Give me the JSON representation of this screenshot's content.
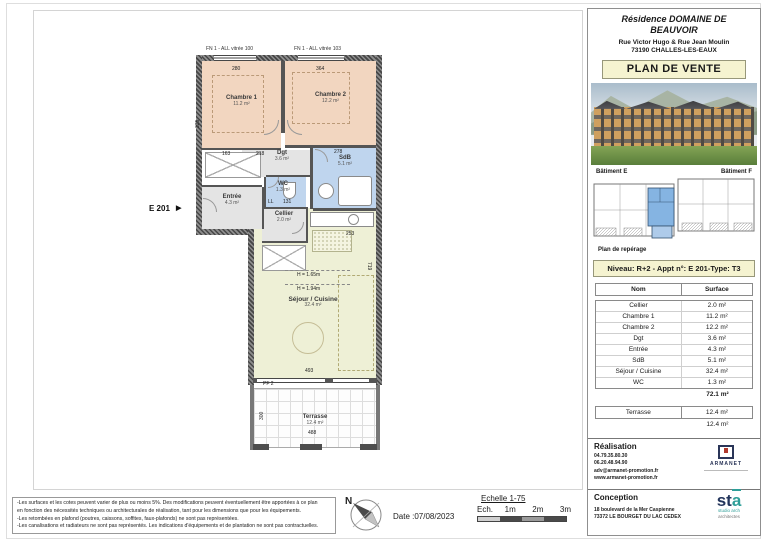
{
  "header": {
    "title_line1": "Résidence DOMAINE DE",
    "title_line2": "BEAUVOIR",
    "address_line1": "Rue Victor Hugo & Rue Jean Moulin",
    "address_line2": "73190 CHALLES-LES-EAUX",
    "plan_label": "PLAN DE VENTE"
  },
  "reperage": {
    "batiment_left": "Bâtiment E",
    "batiment_right": "Bâtiment F",
    "caption": "Plan de repérage"
  },
  "apartment_info": "Niveau: R+2  - Appt n°: E 201-Type: T3",
  "surface_table": {
    "col_name": "Nom",
    "col_surface": "Surface",
    "rows": [
      {
        "name": "Cellier",
        "surface": "2.0 m²"
      },
      {
        "name": "Chambre 1",
        "surface": "11.2 m²"
      },
      {
        "name": "Chambre 2",
        "surface": "12.2 m²"
      },
      {
        "name": "Dgt",
        "surface": "3.6 m²"
      },
      {
        "name": "Entrée",
        "surface": "4.3 m²"
      },
      {
        "name": "SdB",
        "surface": "5.1 m²"
      },
      {
        "name": "Séjour / Cuisine",
        "surface": "32.4 m²"
      },
      {
        "name": "WC",
        "surface": "1.3 m²"
      }
    ],
    "total": "72.1 m²",
    "terrasse_name": "Terrasse",
    "terrasse_surface": "12.4 m²",
    "terrasse_total": "12.4 m²"
  },
  "realisation": {
    "title": "Réalisation",
    "phone1": "04.79.35.80.30",
    "phone2": "06.20.48.94.90",
    "email": "adv@armanet-promotion.fr",
    "website": "www.armanet-promotion.fr",
    "logo_text": "ARMANET"
  },
  "conception": {
    "title": "Conception",
    "address_line1": "18 boulevard de la Mer Caspienne",
    "address_line2": "73372 LE BOURGET DU LAC CEDEX",
    "logo_st": "st",
    "logo_a": "a",
    "logo_sub1": "studio arch",
    "logo_sub2": "architectes"
  },
  "plan": {
    "unit_label": "E 201",
    "unit_arrow": "▶",
    "window_label_1": "FN 1 - ALL vitrée 100",
    "window_label_2": "FN 1 - ALL vitrée 103",
    "rooms": {
      "chambre1": {
        "name": "Chambre 1",
        "area": "11.2 m²"
      },
      "chambre2": {
        "name": "Chambre 2",
        "area": "12.2 m²"
      },
      "dgt": {
        "name": "Dgt",
        "area": "3.6 m²"
      },
      "sdb": {
        "name": "SdB",
        "area": "5.1 m²"
      },
      "wc": {
        "name": "WC",
        "area": "1.3 m²"
      },
      "entree": {
        "name": "Entrée",
        "area": "4.3 m²"
      },
      "cellier": {
        "name": "Cellier",
        "area": "2.0 m²"
      },
      "sejour": {
        "name": "Séjour / Cuisine",
        "area": "32.4 m²"
      },
      "terrasse": {
        "name": "Terrasse",
        "area": "12.4 m²"
      }
    },
    "heights": {
      "h1": "H = 1.65m",
      "h2": "H = 1.94m"
    },
    "dims": {
      "top1": "280",
      "top2": "364",
      "left1": "325",
      "mid1": "163",
      "mid2": "218",
      "sdb": "278",
      "kitchen": "253",
      "sejour_w": "493",
      "sejour_h": "719",
      "terr_h": "300",
      "terr_w": "488",
      "pf": "PF 2",
      "ll": "LL",
      "n131": "131"
    }
  },
  "footer": {
    "disclaimer_line1": "-Les surfaces et les cotes peuvent varier de plus ou moins 5%. Des modifications peuvent éventuellement être apportées à ce plan",
    "disclaimer_line2": "en fonction des nécessités techniques ou architecturales de réalisation, tant pour les dimensions que pour les équipements.",
    "disclaimer_line3": "-Les retombées en plafond (poutres, caissons, soffites, faux-plafonds) ne sont pas représentées.",
    "disclaimer_line4": "-Les canalisations et radiateurs ne sont pas représentés. Les indications d'équipements et de plantation ne sont pas contractuelles.",
    "north_label": "N",
    "date": "Date :07/08/2023",
    "scale_title": "Echelle 1-75",
    "scale_prefix": "Ech.",
    "tick1": "1m",
    "tick2": "2m",
    "tick3": "3m"
  },
  "colors": {
    "room_bedroom": "#f2d6c0",
    "room_wet": "#bfd5ee",
    "room_service": "#e4e4e4",
    "room_living": "#eef0d6",
    "highlight_blue": "#85b4e2",
    "accent_yellow": "#f5f3d0"
  }
}
